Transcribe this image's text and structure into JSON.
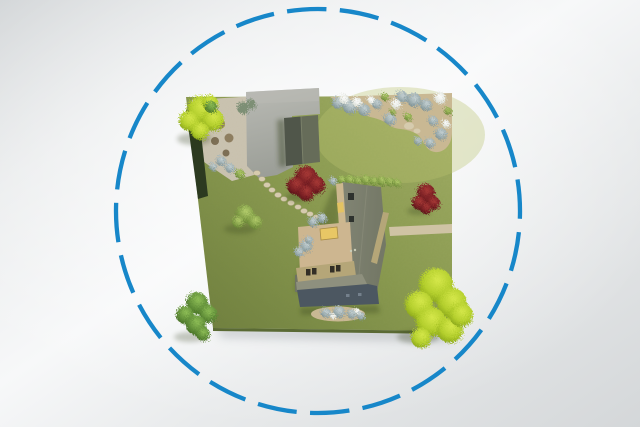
{
  "scene": {
    "type": "aerial-property-render",
    "description": "Top-down 3D render of a residential plot with a main house, garden shed, driveway, gravel patio, flower beds and trees, enclosed by a dashed blue boundary circle on a soft grey gradient backdrop"
  },
  "boundary": {
    "shape": "circle",
    "stroke_style": "dashed"
  },
  "colors": {
    "circle_stroke": "#1787c9",
    "bg_dark": "#d4d7d9",
    "bg_mid": "#e9ebec",
    "bg_light": "#f7f8f9",
    "glow_white": "#ffffff",
    "shadow_ink": "#2f3a18",
    "lot_drop_shadow": "#9aa0a4",
    "grass_light": "#a4b068",
    "grass_mid": "#8a9a50",
    "grass_dark": "#6d7d3d",
    "grass_glow": "#b9c470",
    "grass_edge_face": "#5a6a34",
    "driveway": "#9b9e97",
    "driveway_light": "#b9bab4",
    "gravel": "#cac3b1",
    "soil": "#c9b893",
    "path_tan": "#cfc3a4",
    "stone": "#d6cbae",
    "stone_edge": "#b3a789",
    "hedge_dark": "#2c3a20",
    "shed_dark": "#50564a",
    "shed_light": "#666c59",
    "shed_ridge": "#7a8069",
    "roof_west": "#696e5d",
    "roof_mid": "#838676",
    "roof_east": "#747866",
    "roof_vent": "#2e322e",
    "roof_dot_light": "#c9ccb8",
    "roof_light_band": "#8e907e",
    "roof_slate": "#4c5761",
    "slate_mark": "#7b8894",
    "wall_tan": "#b5a678",
    "terrace": "#cdb690",
    "terrace_north": "#cdb88f",
    "table_gold": "#e8c765",
    "table_edge": "#a98d45",
    "bench_gold": "#e3c362",
    "window_dark": "#332f26",
    "furniture_brown": "#8e7e60",
    "furniture_brown2": "#7d6f55",
    "bush_dark": "#3a4731",
    "bush_sage": "#7d8f74",
    "tree_chartreuse_hi": "#d6e84b",
    "tree_chartreuse_mid": "#b4cf2d",
    "tree_chartreuse_lo": "#7e9b15",
    "tree_green_hi": "#8fbf57",
    "tree_green_mid": "#63913a",
    "tree_green_lo": "#3e661f",
    "tree_red_hi": "#a93a36",
    "tree_red_mid": "#7c2125",
    "tree_red_lo": "#4e1013",
    "shrub_gray_hi": "#c9d4d6",
    "shrub_gray_mid": "#93a5a8",
    "shrub_gray_lo": "#6b7f82",
    "flower_white_hi": "#ffffff",
    "flower_white_mid": "#dfe3dc",
    "flower_white_lo": "#a9b2a5",
    "bush_olive_hi": "#b6cf6e",
    "bush_olive_mid": "#7d9a43",
    "bush_olive_lo": "#52702a"
  }
}
